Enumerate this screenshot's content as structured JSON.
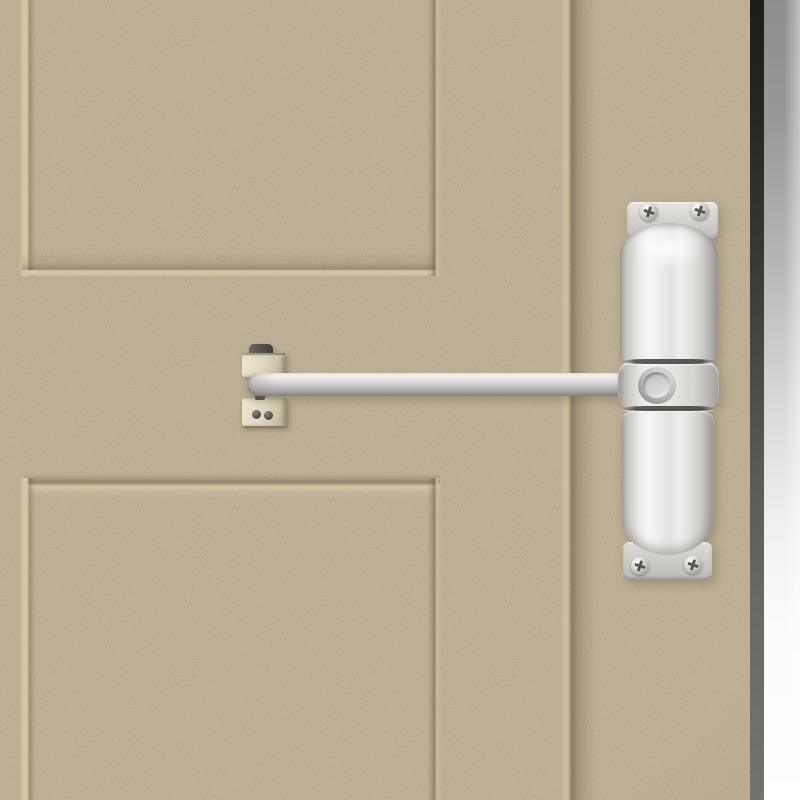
{
  "scene": {
    "label": "White surface-mounted automatic spring door closer installed on a beige textured door with recessed panels",
    "door": {
      "label": "Beige speckled door face with two recessed square panels, a lock stile groove and the door edge on the right",
      "panels": [
        "upper recessed panel",
        "lower recessed panel"
      ]
    },
    "closer": {
      "label": "White automatic door closer: top mounting plate, upper spring tube, adjustment collar with round adjustment hole, lower spring tube, bottom mounting plate",
      "parts": {
        "top_plate": "top mounting plate",
        "upper_tube": "upper spring tube",
        "collar": "adjustment collar",
        "hole": "adjustment hole",
        "lower_tube": "lower spring tube",
        "bottom_plate": "bottom mounting plate"
      },
      "screw_count": 4
    },
    "arm": {
      "label": "Light grey closer arm rod running from the jamb bracket to the closer collar"
    },
    "bracket": {
      "label": "Cream two-block jamb bracket anchoring the arm with a dark pivot pin",
      "screw_count": 2
    }
  },
  "colors": {
    "door_base": "#b5a88a",
    "groove_highlight": "#d3c7a7",
    "groove_shadow": "#6f6350",
    "door_edge_top": "#1c1c1a",
    "door_edge_bottom": "#727270",
    "background_top": "#8d8d8b",
    "background_bottom": "#ffffff",
    "closer_body_light": "#f7f6f4",
    "closer_body_shade": "#9d9b97",
    "mounting_plate": "#d6d4d0",
    "arm_rod": "#d6d4d2",
    "bracket_cream": "#ddd6bc",
    "pivot_pin": "#504e4a",
    "screw_metal": "#c3c1be",
    "screw_slot": "#57554f",
    "seam_line": "#464440"
  }
}
